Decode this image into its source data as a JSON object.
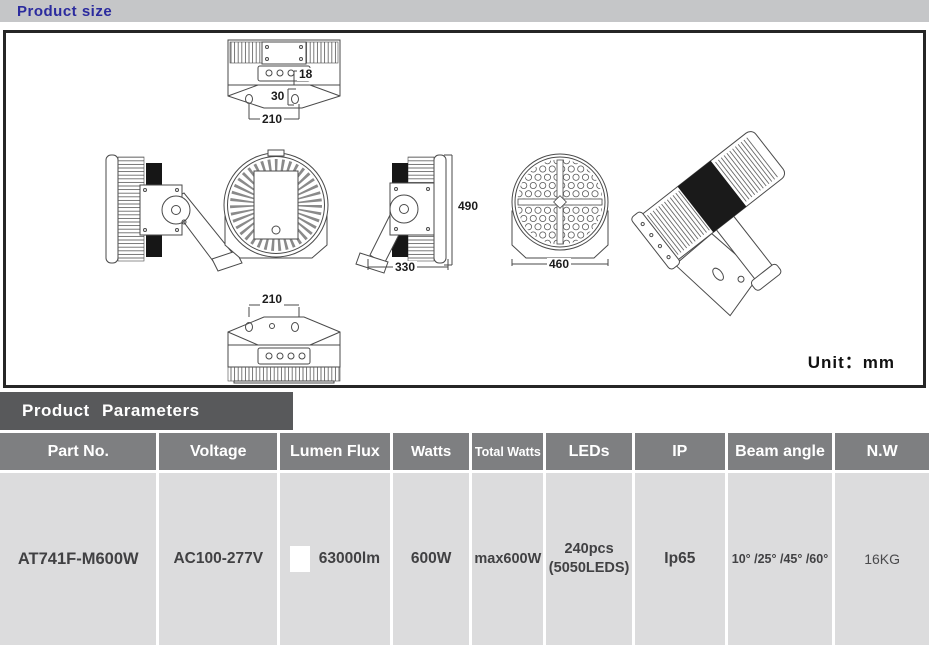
{
  "header": {
    "title": "Product size"
  },
  "drawing": {
    "unit_text": "Unit：mm",
    "dims": {
      "top_small": "18",
      "top_offset": "30",
      "top_mount_width": "210",
      "height": "490",
      "side_width": "330",
      "diameter": "460",
      "bottom_mount_width": "210"
    }
  },
  "parameters": {
    "section_title": "Product Parameters",
    "columns": [
      "Part No.",
      "Voltage",
      "Lumen Flux",
      "Watts",
      "Total Watts",
      "LEDs",
      "IP",
      "Beam angle",
      "N.W"
    ],
    "row": {
      "part_no": "AT741F-M600W",
      "voltage": "AC100-277V",
      "lumen_flux": "63000lm",
      "watts": "600W",
      "total_watts": "max600W",
      "leds_line1": "240pcs",
      "leds_line2": "(5050LEDS)",
      "ip": "Ip65",
      "beam_angle": "10° /25° /45° /60°",
      "nw": "16KG"
    }
  }
}
